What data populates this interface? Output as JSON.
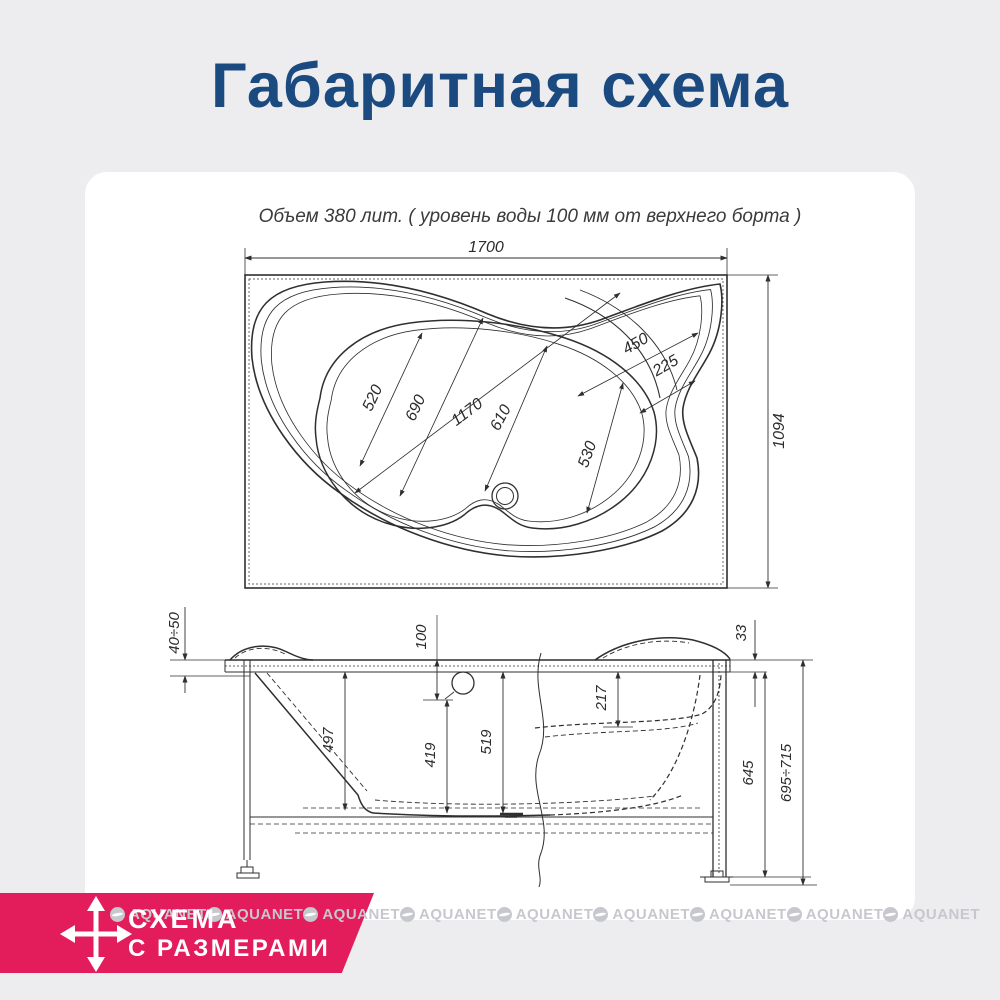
{
  "page": {
    "title": "Габаритная схема"
  },
  "drawing": {
    "note": "Объем 380 лит. ( уровень воды 100 мм от верхнего борта )",
    "top_view": {
      "total_width": "1700",
      "total_depth": "1094",
      "width_520": "520",
      "width_690": "690",
      "length_1170": "1170",
      "width_610": "610",
      "width_530": "530",
      "corner_450": "450",
      "corner_225": "225"
    },
    "side_view": {
      "rim_drop": "40÷50",
      "water_level": "100",
      "rim_thickness": "33",
      "seat_depth": "217",
      "depth_497": "497",
      "depth_419": "419",
      "depth_519": "519",
      "height_645": "645",
      "height_total": "695÷715"
    }
  },
  "badge": {
    "line1": "СХЕМА",
    "line2": "С РАЗМЕРАМИ",
    "color": "#e31c5c",
    "icon": "move-arrows-icon"
  },
  "watermark": {
    "text": "AQUANET"
  },
  "colors": {
    "background": "#ededef",
    "card": "#ffffff",
    "title": "#1b4a80",
    "line": "#2f2f2f",
    "watermark": "#c7c8ce"
  }
}
